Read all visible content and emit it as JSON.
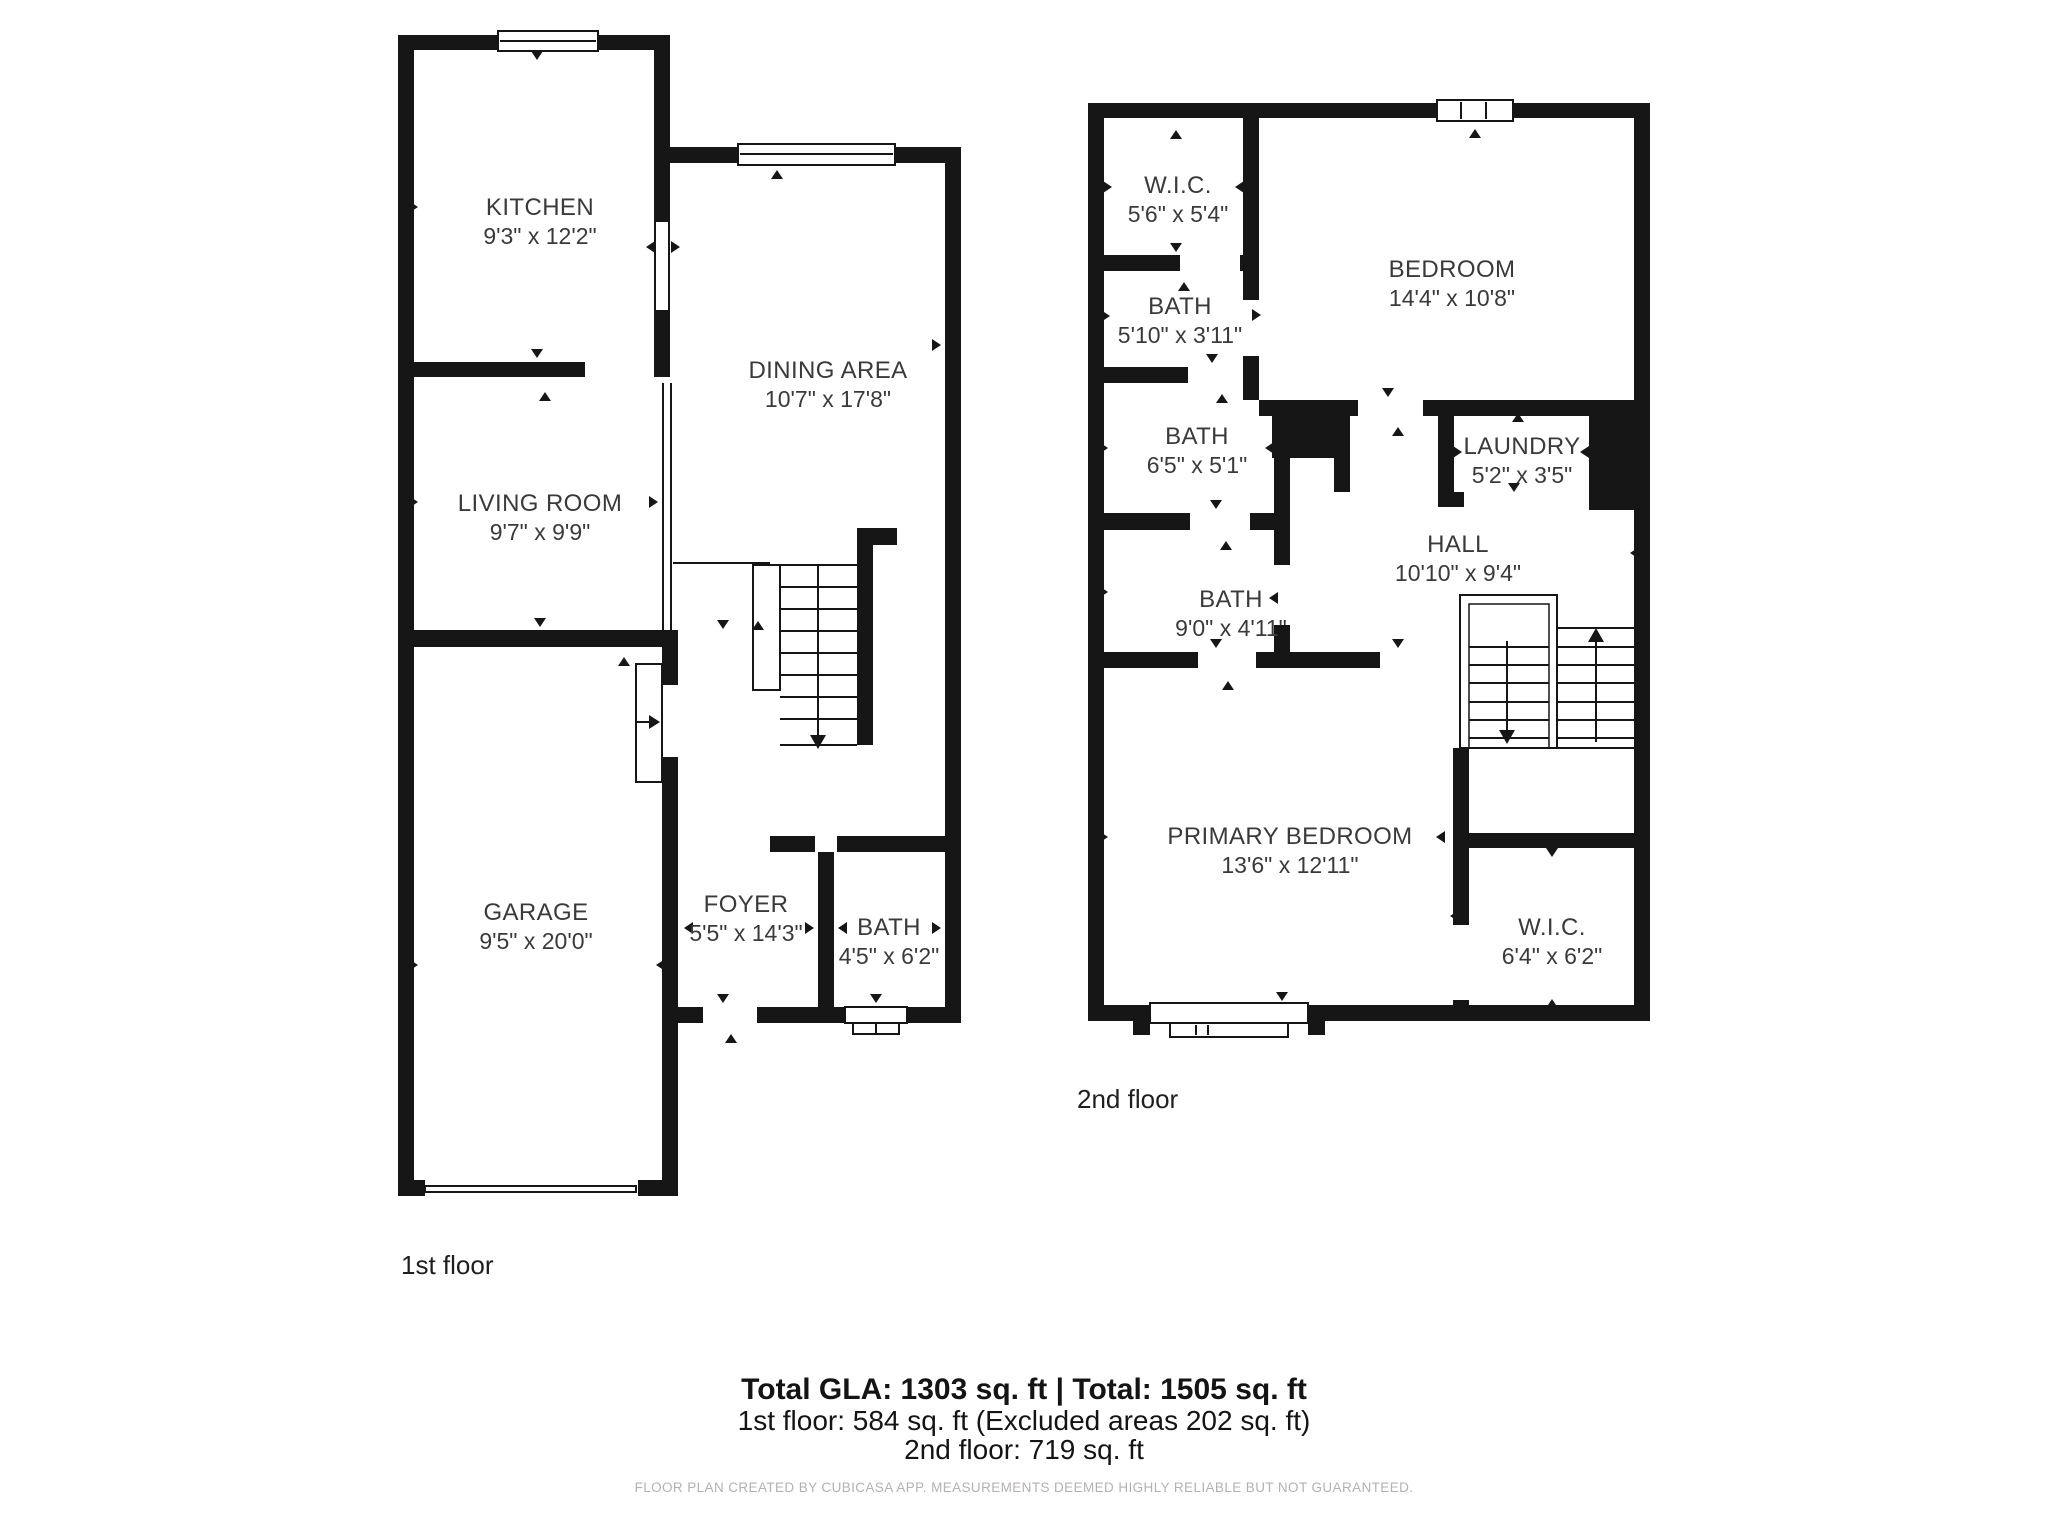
{
  "floors": [
    {
      "caption": "1st floor",
      "rooms": [
        {
          "name": "KITCHEN",
          "dims": "9'3\" x 12'2\""
        },
        {
          "name": "DINING AREA",
          "dims": "10'7\" x 17'8\""
        },
        {
          "name": "LIVING ROOM",
          "dims": "9'7\" x 9'9\""
        },
        {
          "name": "GARAGE",
          "dims": "9'5\" x 20'0\""
        },
        {
          "name": "FOYER",
          "dims": "5'5\" x 14'3\""
        },
        {
          "name": "BATH",
          "dims": "4'5\" x 6'2\""
        }
      ]
    },
    {
      "caption": "2nd floor",
      "rooms": [
        {
          "name": "W.I.C.",
          "dims": "5'6\" x 5'4\""
        },
        {
          "name": "BATH",
          "dims": "5'10\" x 3'11\""
        },
        {
          "name": "BEDROOM",
          "dims": "14'4\" x 10'8\""
        },
        {
          "name": "BATH",
          "dims": "6'5\" x 5'1\""
        },
        {
          "name": "LAUNDRY",
          "dims": "5'2\" x 3'5\""
        },
        {
          "name": "HALL",
          "dims": "10'10\" x 9'4\""
        },
        {
          "name": "BATH",
          "dims": "9'0\" x 4'11\""
        },
        {
          "name": "PRIMARY BEDROOM",
          "dims": "13'6\" x 12'11\""
        },
        {
          "name": "W.I.C.",
          "dims": "6'4\" x 6'2\""
        }
      ]
    }
  ],
  "summary": {
    "line1": "Total GLA: 1303 sq. ft | Total: 1505 sq. ft",
    "line2": "1st floor: 584 sq. ft (Excluded areas 202 sq. ft)",
    "line3": "2nd floor: 719 sq. ft",
    "disclaimer": "FLOOR PLAN CREATED BY CUBICASA APP. MEASUREMENTS DEEMED HIGHLY RELIABLE BUT NOT GUARANTEED."
  },
  "icons": [
    "window-icon",
    "staircase-icon",
    "stair-up-arrow-icon",
    "stair-down-arrow-icon",
    "door-swing-arrow-icon",
    "door-opening-tick-icon"
  ],
  "colors": {
    "wall": "#161616",
    "label_text": "#3a3a3a",
    "disclaimer_text": "#b4b1b1",
    "background": "#ffffff"
  }
}
